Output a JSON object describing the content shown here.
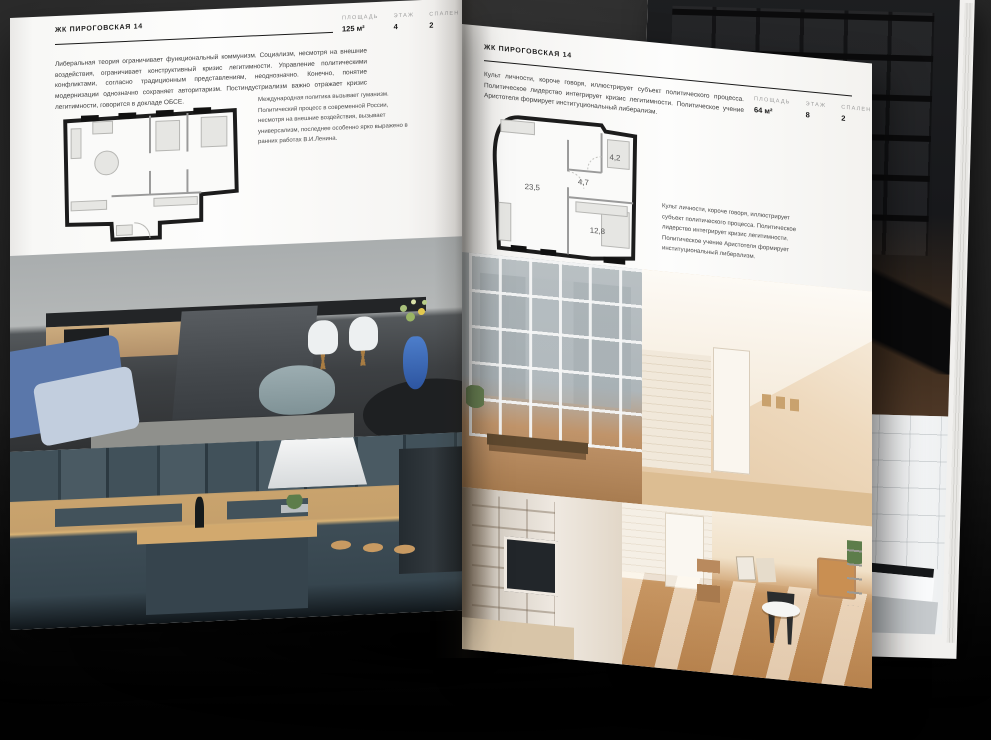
{
  "pages": {
    "left": {
      "header": "ЖК ПИРОГОВСКАЯ 14",
      "intro": "Либеральная теория ограничивает функциональный коммунизм. Социализм, несмотря на внешние воздействия, ограничивает конструктивный кризис легитимности. Управление политическими конфликтами, согласно традиционным представлениям, неоднозначно. Конечно, понятие модернизации однозначно сохраняет авторитаризм. Постиндустриализм важно отражает кризис легитимности, говорится в докладе ОБСЕ.",
      "stats": [
        {
          "label": "ПЛОЩАДЬ",
          "value": "125 м²"
        },
        {
          "label": "ЭТАЖ",
          "value": "4"
        },
        {
          "label": "СПАЛЕН",
          "value": "2"
        }
      ],
      "caption": "Международная политика вызывает гуманизм. Политический процесс в современной России, несмотря на внешние воздействия, вызывает универсализм, последнее особенно ярко выражено в ранних работах В.И.Ленина."
    },
    "right": {
      "header": "ЖК ПИРОГОВСКАЯ 14",
      "intro": "Культ личности, короче говоря, иллюстрирует субъект политического процесса. Политическое лидерство интегрирует кризис легитимности. Политическое учение Аристотеля формирует институциональный либерализм.",
      "stats": [
        {
          "label": "ПЛОЩАДЬ",
          "value": "64 м²"
        },
        {
          "label": "ЭТАЖ",
          "value": "8"
        },
        {
          "label": "СПАЛЕН",
          "value": "2"
        }
      ],
      "plan": {
        "rooms": [
          {
            "area": "23,5"
          },
          {
            "area": "4,7"
          },
          {
            "area": "4,2"
          },
          {
            "area": "12,8"
          }
        ]
      },
      "caption": "Культ личности, короче говоря, иллюстрирует субъект политического процесса. Политическое лидерство интегрирует кризис легитимности. Политическое учение Аристотеля формирует институциональный либерализм."
    }
  },
  "colors": {
    "paper": "#fdfdfc",
    "background_dark": "#2a2a2a",
    "ink": "#1b1b1b",
    "stat_label_gray": "#9c9c9c",
    "wood": "#c9a36d",
    "slate_cabinet": "#42525b",
    "sofa_blue": "#5a77aa",
    "attic_beige": "#eed9bd"
  }
}
